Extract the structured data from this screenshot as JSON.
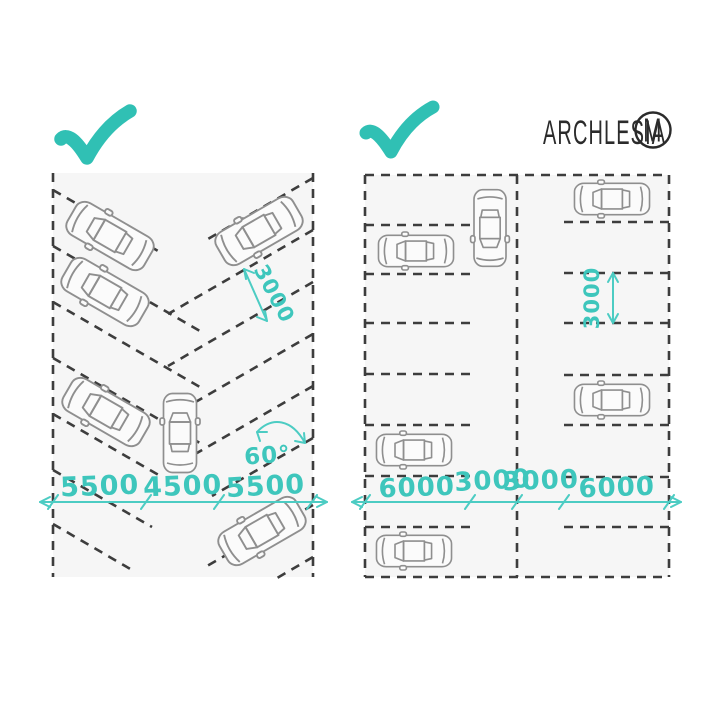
{
  "brand": {
    "name": "ARCHLESIA",
    "monogram": "M"
  },
  "colors": {
    "accent_teal": "#3EC6BC",
    "line_ink": "#3D3D3D",
    "car_outline": "#8F8F8F"
  },
  "left_diagram": {
    "type": "angled 60-degree parking layout",
    "approved": true,
    "bottom_dimensions": [
      "5500",
      "4500",
      "5500"
    ],
    "slot_width_label": "3000",
    "angle_label": "60°",
    "car_count": 6
  },
  "right_diagram": {
    "type": "perpendicular parking layout",
    "approved": true,
    "bottom_dimensions": [
      "6000",
      "3000",
      "3000",
      "6000"
    ],
    "slot_width_label": "3000",
    "car_count": 6
  }
}
